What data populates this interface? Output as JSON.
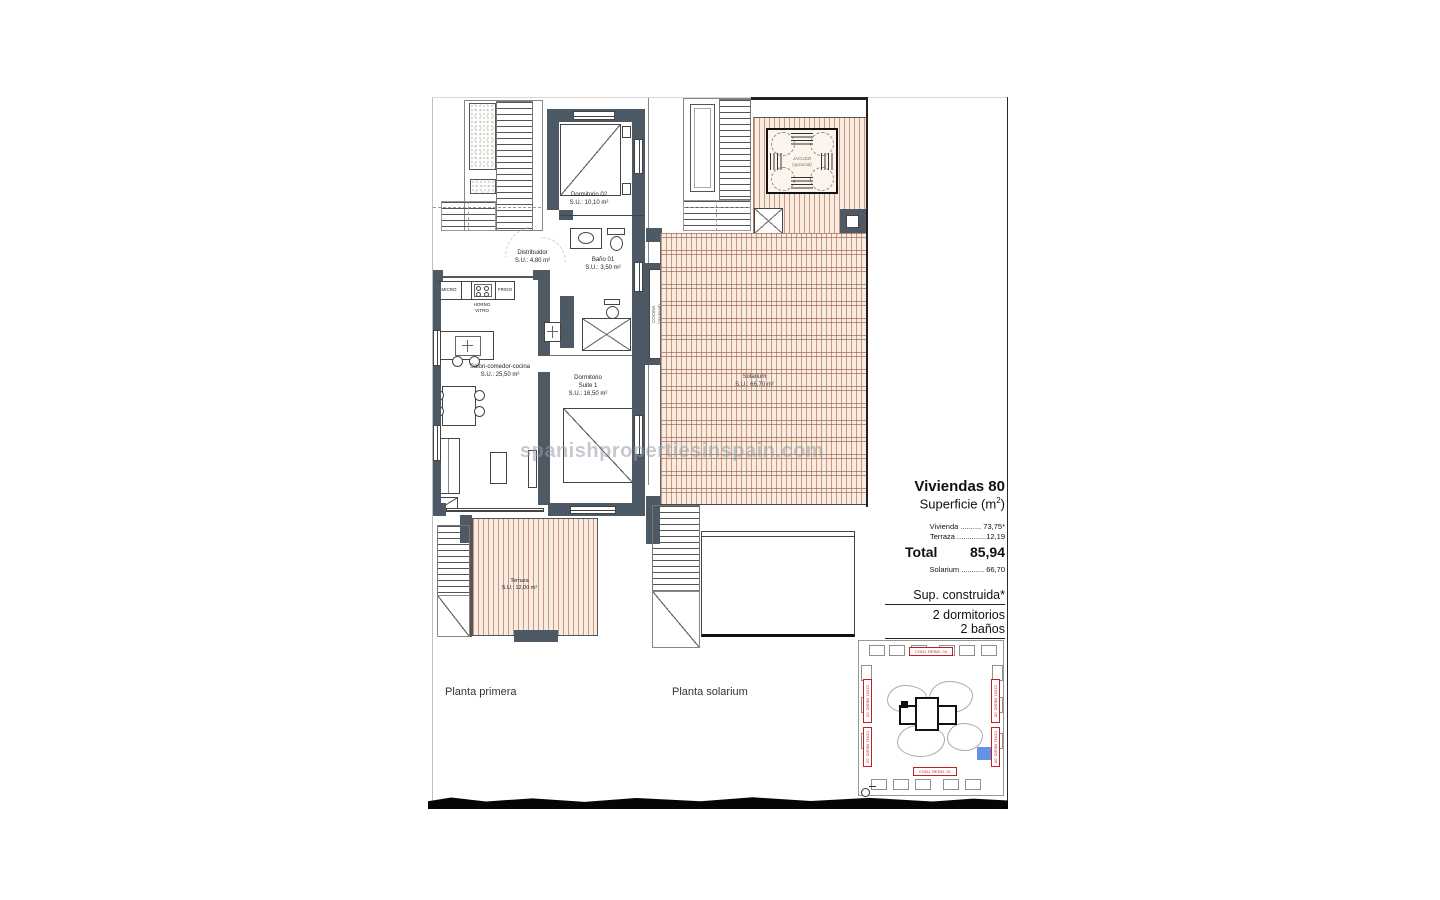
{
  "watermark": {
    "text": "spanishpropertiesinspain.com"
  },
  "plan_primera": {
    "title": "Planta primera",
    "rooms": {
      "dormitorio02": {
        "name": "Dormitorio 02",
        "area": "S.U.: 10,10 m²"
      },
      "distribuidor": {
        "name": "Distribuidor",
        "area": "S.U.: 4,80 m²"
      },
      "bano01": {
        "name": "Baño 01",
        "area": "S.U.: 3,50 m²"
      },
      "salon": {
        "name": "Salon-comedor-cocina",
        "area": "S.U.: 25,50 m²"
      },
      "suite": {
        "name": "Dormitorio",
        "name2": "Suite 1",
        "area": "S.U.: 16,50 m²"
      },
      "terraza": {
        "name": "Terraza",
        "area": "S.U.: 12,00 m²"
      }
    },
    "kitchen": {
      "micro": "MICRO",
      "frigo": "FRIGO",
      "horno1": "HORNO",
      "horno2": "VITRO"
    }
  },
  "plan_solarium": {
    "title": "Planta solarium",
    "rooms": {
      "solarium": {
        "name": "Solarium",
        "area": "S.U.: 66,70 m²"
      },
      "jacuzzi": {
        "name": "JACUZZI",
        "name2": "(opcional)"
      },
      "cocina": {
        "name": "COCINA",
        "name2": "(opcional)"
      }
    }
  },
  "info_panel": {
    "title": "Viviendas 80",
    "superficie_pre": "Superficie (m",
    "superficie_sup": "2",
    "superficie_post": ")",
    "row_vivienda": "Vivienda .......... 73,75*",
    "row_terraza": "Terraza ..............12,19",
    "total_label": "Total",
    "total_value": "85,94",
    "row_solarium": "Solarium ........... 66,70",
    "sup_construida": "Sup. construida*",
    "bedrooms": "2 dormitorios",
    "bathrooms": "2 baños"
  },
  "site_map": {
    "labels": {
      "top": "CONJ. RESID. 04",
      "left_top": "CONJ. RESID. 03",
      "left_bottom": "CONJ. RESID. 02",
      "right_top": "CONJ. RESID. 05",
      "right_bottom": "CONJ. RESID. 06",
      "bottom": "CONJ. RESID. 01"
    }
  },
  "colors": {
    "wall": "#4d5a66",
    "deck_line": "#c9997f",
    "deck_bg": "#f8ece2",
    "map_accent": "#c22020",
    "highlight_unit": "#4a7fe0"
  }
}
